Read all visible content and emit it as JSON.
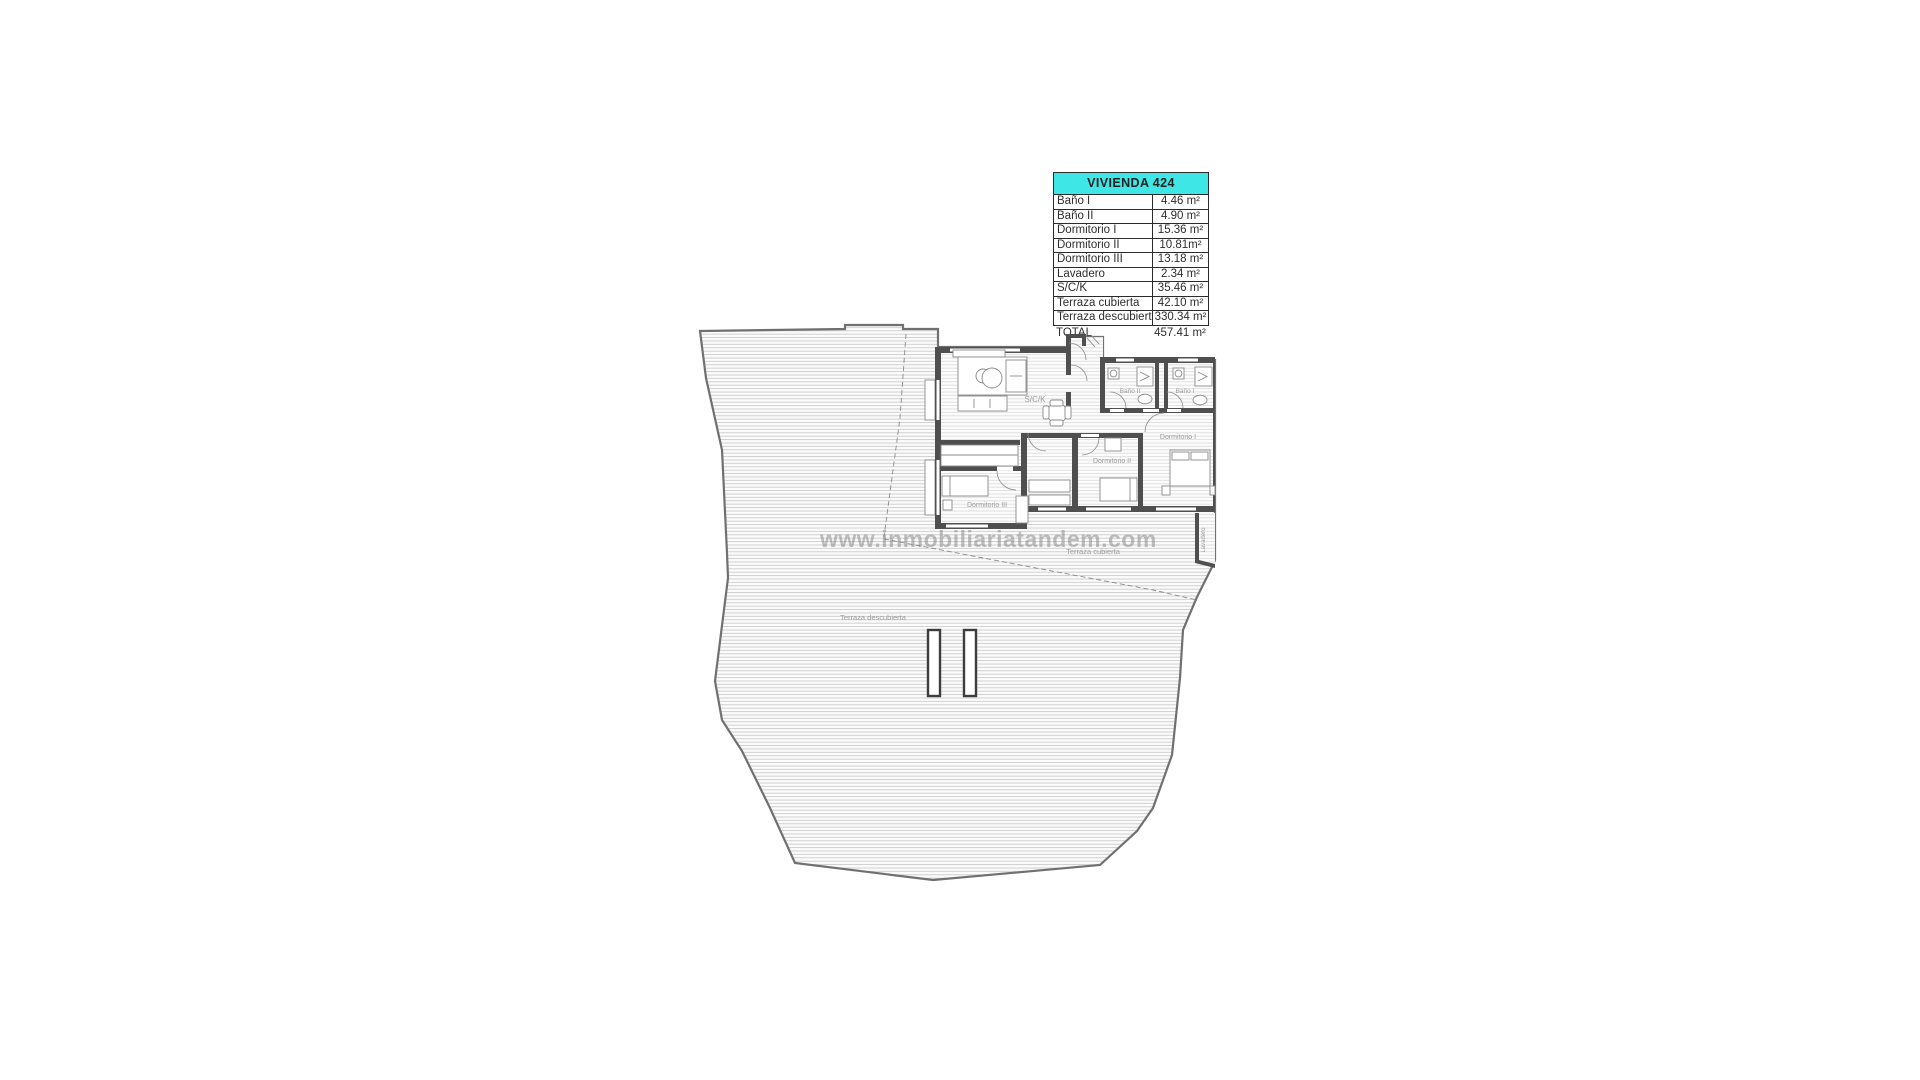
{
  "watermark": "www.inmobiliariatandem.com",
  "colors": {
    "accent_header": "#3ee6e6",
    "wall": "#4f4f4f",
    "hatch": "#c9c9c9",
    "label_gray": "#9b9b9b"
  },
  "table": {
    "title": "VIVIENDA 424",
    "rows": [
      {
        "label": "Baño I",
        "value": "4.46 m²"
      },
      {
        "label": "Baño II",
        "value": "4.90 m²"
      },
      {
        "label": "Dormitorio I",
        "value": "15.36 m²"
      },
      {
        "label": "Dormitorio II",
        "value": "10.81m²"
      },
      {
        "label": "Dormitorio III",
        "value": "13.18 m²"
      },
      {
        "label": "Lavadero",
        "value": "2.34 m²"
      },
      {
        "label": "S/C/K",
        "value": "35.46 m²"
      },
      {
        "label": "Terraza cubierta",
        "value": "42.10 m²"
      },
      {
        "label": "Terraza descubierta",
        "value": "330.34 m²"
      }
    ],
    "total": {
      "label": "TOTAL",
      "value": "457.41 m²"
    }
  },
  "plan": {
    "labels": {
      "sck": "S/C/K",
      "banyo1": "Baño I",
      "banyo2": "Baño II",
      "dorm1": "Dormitorio I",
      "dorm2": "Dormitorio II",
      "dorm3": "Dormitorio III",
      "lavadero": "Lavadero",
      "terraza_cubierta": "Terraza cubierta",
      "terraza_descubierta": "Terraza descubierta"
    }
  }
}
